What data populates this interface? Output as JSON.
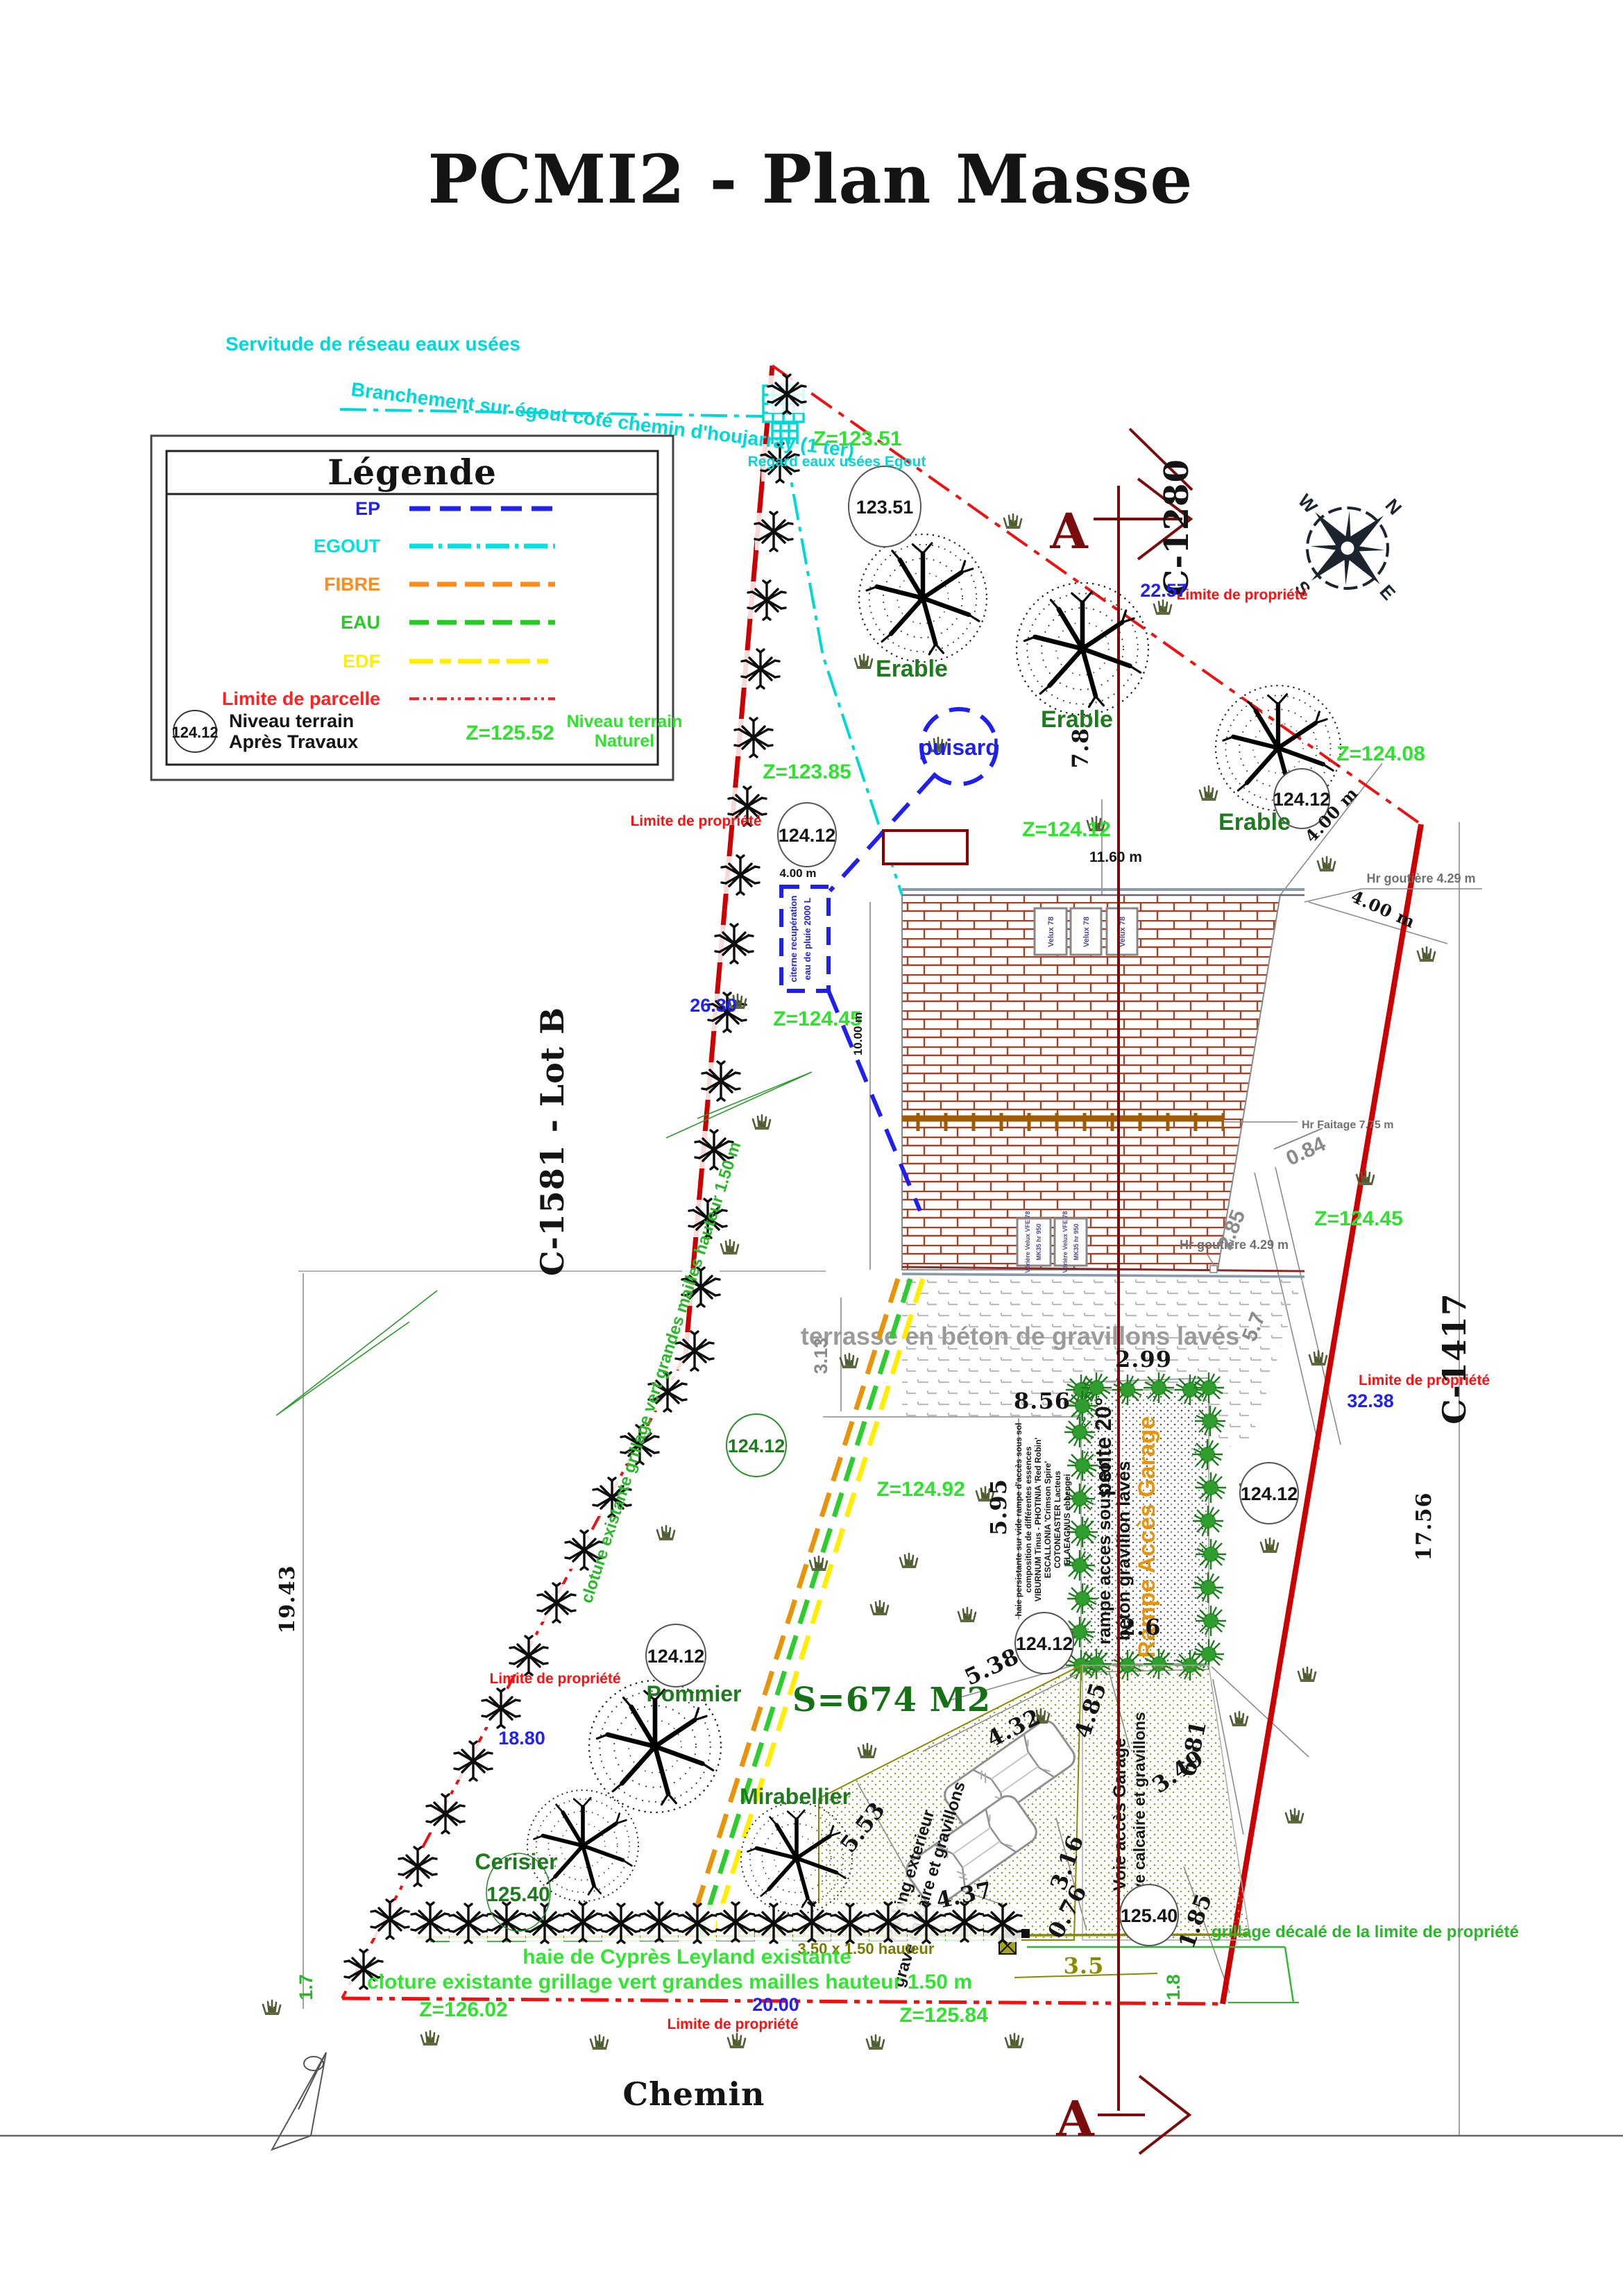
{
  "plan": {
    "title": "PCMI2 - Plan Masse",
    "labels": {
      "servitude": "Servitude de réseau eaux usées",
      "branchement": "Branchement sur égout coté chemin d'houjarray (1 ter)",
      "regard": "Regard eaux usées Egout",
      "puisard": "puisard",
      "citerne_l1": "citerne recupération",
      "citerne_l2": "eau de pluie 2000 L",
      "terrasse": "terrasse en béton de gravillons lavés",
      "pente": "pente 20°",
      "rampe_l1": "rampe acces sous sol",
      "rampe_l2": "béton gravillon lavés",
      "rampe_garage": "Rampe Accès Garage",
      "haie_persistante": [
        "haie persistante sur vide rampe d'accès sous sol",
        "composition de différentes essences",
        "VIBURNUM Tinus - PHOTINIA 'Red Robin'",
        "ESCALLONIA 'Crimson Spire'",
        "COTONEASTER Lacteus",
        "ELAEAGNUS ebbengei"
      ],
      "parking_l1": "Parking exterieur",
      "parking_l2": "grave calcaire et gravillons",
      "voie_l1": "Voie accès Garage",
      "voie_l2": "grave calcaire et gravillons",
      "portail_l1": "Portail en Aluminium Ral 7016 plein",
      "portail_l2": "3.50 x 1.50 hauteur",
      "grillage_decale": "grillage décalé de la limite de propriété",
      "haie_cypres": "haie de Cyprès Leyland existante",
      "cloture": "cloture existante grillage vert grandes mailles hauteur 1.50 m",
      "limite": "Limite de propriété",
      "chemin": "Chemin",
      "surface": "S=674 M2",
      "lot_b": "C-1581 - Lot B",
      "c1280": "C-1280",
      "c1417": "C-1417",
      "hr_goutiere": "Hr goutière 4.29 m",
      "hr_faitage": "Hr Faitage 7.75 m",
      "velux": "Velux 78",
      "verriere_l1": "Vérière Velux VFE 78",
      "verriere_l2": "MK35 hr 950",
      "erable": "Erable",
      "pommier": "Pommier",
      "cerisier": "Cerisier",
      "mirabellier": "Mirabellier",
      "section": "A"
    },
    "levels": {
      "z12351": "Z=123.51",
      "c12351": "123.51",
      "z12385": "Z=123.85",
      "z12412": "Z=124.12",
      "z12408": "Z=124.08",
      "z12445": "Z=124.45",
      "z12492": "Z=124.92",
      "z12602": "Z=126.02",
      "z12584": "Z=125.84",
      "n12412": "124.12",
      "n12540": "125.40",
      "t12540": "125.40"
    },
    "dims": {
      "d2257": "22.57",
      "d2630": "26.30",
      "d1880": "18.80",
      "d3238": "32.38",
      "d2000": "20.00",
      "d1943": "19.43",
      "d1756": "17.56",
      "d78": "7.8",
      "d299": "2.99",
      "d856": "8.56",
      "d595": "5.95",
      "d26": "2.6",
      "d538": "5.38",
      "d432": "4.32",
      "d485": "4.85",
      "d349": "3.49",
      "d681": "6.81",
      "d316": "3.16",
      "d076": "0.76",
      "d437": "4.37",
      "d553": "5.53",
      "d185": "1.85",
      "d35": "3.5",
      "d18": "1.8",
      "d17": "1.7",
      "d1160": "11.60 m",
      "d1000": "10.00 m",
      "d400": "4.00 m",
      "d313": "3.13",
      "d285": "2.85",
      "d57": "5.7",
      "d084": "0.84"
    }
  },
  "legend": {
    "title": "Légende",
    "items": [
      {
        "label": "EP",
        "color": "#2222ee",
        "dash": "30,14"
      },
      {
        "label": "EGOUT",
        "color": "#00e0e0",
        "dash": "34,8,5,8"
      },
      {
        "label": "FIBRE",
        "color": "#ff8c1a",
        "dash": "28,12"
      },
      {
        "label": "EAU",
        "color": "#22cc22",
        "dash": "28,12"
      },
      {
        "label": "EDF",
        "color": "#ffee00",
        "dash": "34,10,16,10"
      },
      {
        "label": "Limite de parcelle",
        "color": "#ff2222",
        "dash": "14,6,4,6,4,6"
      }
    ],
    "niveau_value": "124.12",
    "niveau_l1": "Niveau terrain",
    "niveau_l2": "Après Travaux",
    "z_value": "Z=125.52",
    "naturel_l1": "Niveau terrain",
    "naturel_l2": "Naturel"
  },
  "compass": {
    "n": "N",
    "s": "S",
    "e": "E",
    "w": "W"
  },
  "colors": {
    "egout": "#00d8d8",
    "ep": "#1f1ff0",
    "fibre": "#e8940a",
    "eau": "#22cc22",
    "edf": "#ffee00",
    "limite": "#ff1010",
    "boundary_solid": "#cc0000",
    "section": "#7a0c0c",
    "level_green": "#2ee32e",
    "tree_green": "#1d7a1d",
    "brick": "#a34226",
    "olive": "#8a8a00"
  }
}
